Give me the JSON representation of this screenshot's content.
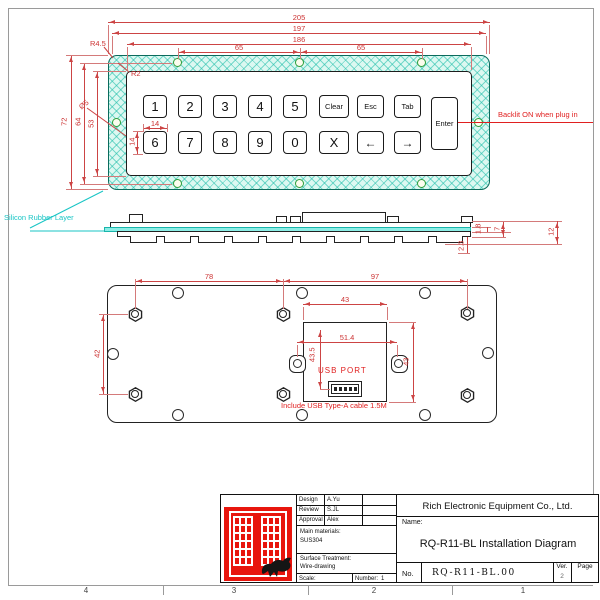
{
  "front_view": {
    "dim_overall_width": "205",
    "dim_mount_width": "197",
    "dim_window_width": "186",
    "dim_hole_span_1": "65",
    "dim_hole_span_2": "65",
    "dim_corner_radius": "R4.5",
    "dim_inner_radius": "R2",
    "dim_hole_dia": "Ø5",
    "dim_overall_height": "72",
    "dim_hole_height": "64",
    "dim_window_height": "53",
    "dim_key_width": "14",
    "dim_key_height": "14",
    "keys_row1": [
      "1",
      "2",
      "3",
      "4",
      "5",
      "Clear",
      "Esc",
      "Tab"
    ],
    "keys_row2": [
      "6",
      "7",
      "8",
      "9",
      "0",
      "X",
      "←",
      "→"
    ],
    "enter_key": "Enter",
    "backlit_note": "Backlit ON when plug in"
  },
  "side_view": {
    "layer_label": "Silicon Rubber Layer",
    "dim_rubber_thickness": "1.8",
    "dim_plate_stack": "7",
    "dim_total_height": "12",
    "dim_key_protrusion": "2.3"
  },
  "bottom_view": {
    "dim_stud_span_left": "78",
    "dim_stud_span_right": "97",
    "dim_stud_span_vertical": "42",
    "dim_cutout_width": "43",
    "dim_ear_span": "51.4",
    "dim_cutout_offset": "43.5",
    "dim_cutout_height": "43",
    "usb_label": "USB  PORT",
    "cable_note": "Include USB Type-A cable 1.5M"
  },
  "title_block": {
    "design_label": "Design",
    "design_value": "A.Yu",
    "review_label": "Review",
    "review_value": "S.JL",
    "approval_label": "Approval",
    "approval_value": "Alex",
    "materials_label": "Main materials:",
    "materials_value": "SUS304",
    "surface_label": "Surface Treatment:",
    "surface_value": "Wire-drawing",
    "scale_label": "Scale:",
    "number_label": "Number:",
    "number_value": "1",
    "company": "Rich Electronic Equipment Co., Ltd.",
    "name_label": "Name:",
    "drawing_title": "RQ-R11-BL Installation Diagram",
    "no_label": "No.",
    "no_value": "RQ-R11-BL.00",
    "ver_label": "Ver.",
    "ver_value": "2",
    "page_label": "Page"
  },
  "frame": {
    "zones": [
      "4",
      "3",
      "2",
      "1"
    ]
  },
  "colors": {
    "dimension_red": "#c44444",
    "note_red": "#e02020",
    "panel_hatch_teal": "#20bEaa",
    "cyan_label": "#18c5c5",
    "logo_red": "#e8150d"
  }
}
